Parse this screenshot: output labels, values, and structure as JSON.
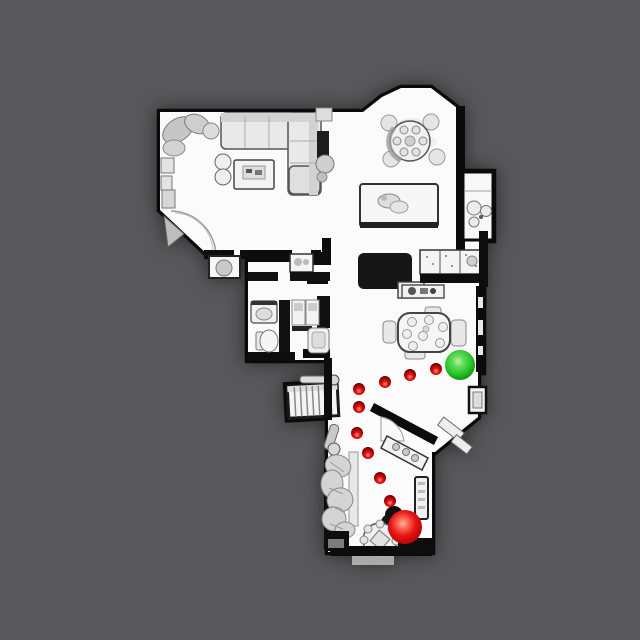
{
  "scene": {
    "description": "Top-down orthographic view of a 3D-scanned house floor plan with a navigation path of red waypoints, a green goal sphere and a red agent sphere",
    "background_color": "#58585a",
    "floor_color": "#fbfbfb",
    "wall_color": "#0a0a0a"
  },
  "markers": {
    "waypoints": {
      "color": "#e01010",
      "radius": 6,
      "points": [
        {
          "x": 436,
          "y": 369
        },
        {
          "x": 410,
          "y": 375
        },
        {
          "x": 385,
          "y": 382
        },
        {
          "x": 359,
          "y": 389
        },
        {
          "x": 359,
          "y": 407
        },
        {
          "x": 357,
          "y": 433
        },
        {
          "x": 368,
          "y": 453
        },
        {
          "x": 380,
          "y": 478
        },
        {
          "x": 390,
          "y": 501
        }
      ]
    },
    "goal": {
      "x": 460,
      "y": 365,
      "radius": 15,
      "color": "#2ec82e"
    },
    "agent": {
      "x": 405,
      "y": 527,
      "radius": 17,
      "color": "#e51414"
    }
  }
}
